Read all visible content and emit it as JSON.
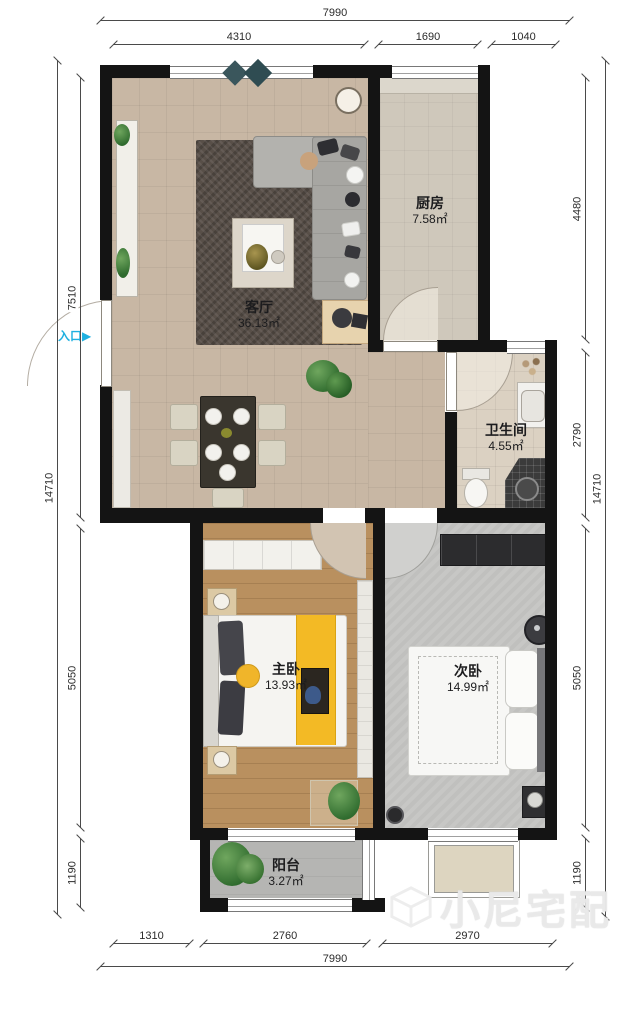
{
  "plan": {
    "entrance": {
      "label": "入口",
      "arrow": "▶"
    },
    "rooms": [
      {
        "name": "客厅",
        "area": "36.13㎡"
      },
      {
        "name": "厨房",
        "area": "7.58㎡"
      },
      {
        "name": "卫生间",
        "area": "4.55㎡"
      },
      {
        "name": "主卧",
        "area": "13.93㎡"
      },
      {
        "name": "次卧",
        "area": "14.99㎡"
      },
      {
        "name": "阳台",
        "area": "3.27㎡"
      }
    ],
    "watermark": "小尼宅配"
  },
  "dimensions": {
    "top": {
      "overall": "7990",
      "segments": [
        "4310",
        "1690",
        "1040"
      ]
    },
    "bottom": {
      "overall": "7990",
      "segments": [
        "1310",
        "2760",
        "2970"
      ]
    },
    "left": {
      "overall": "14710",
      "segments": [
        "7510",
        "5050",
        "1190"
      ]
    },
    "right": {
      "overall": "14710",
      "segments": [
        "4480",
        "2790",
        "5050",
        "1190"
      ]
    }
  },
  "colors": {
    "wall": "#141414",
    "living_floor": "#c8b7a4",
    "kitchen_floor": "#cfc8bb",
    "bath_floor": "#dbd1c2",
    "master_floor": "#b9905f",
    "second_floor": "#c7c7c5",
    "balcony_floor": "#b5b5b3",
    "accent_cyan": "#1fb0e0",
    "accent_yellow": "#f2b829",
    "rug": "#584f48"
  }
}
